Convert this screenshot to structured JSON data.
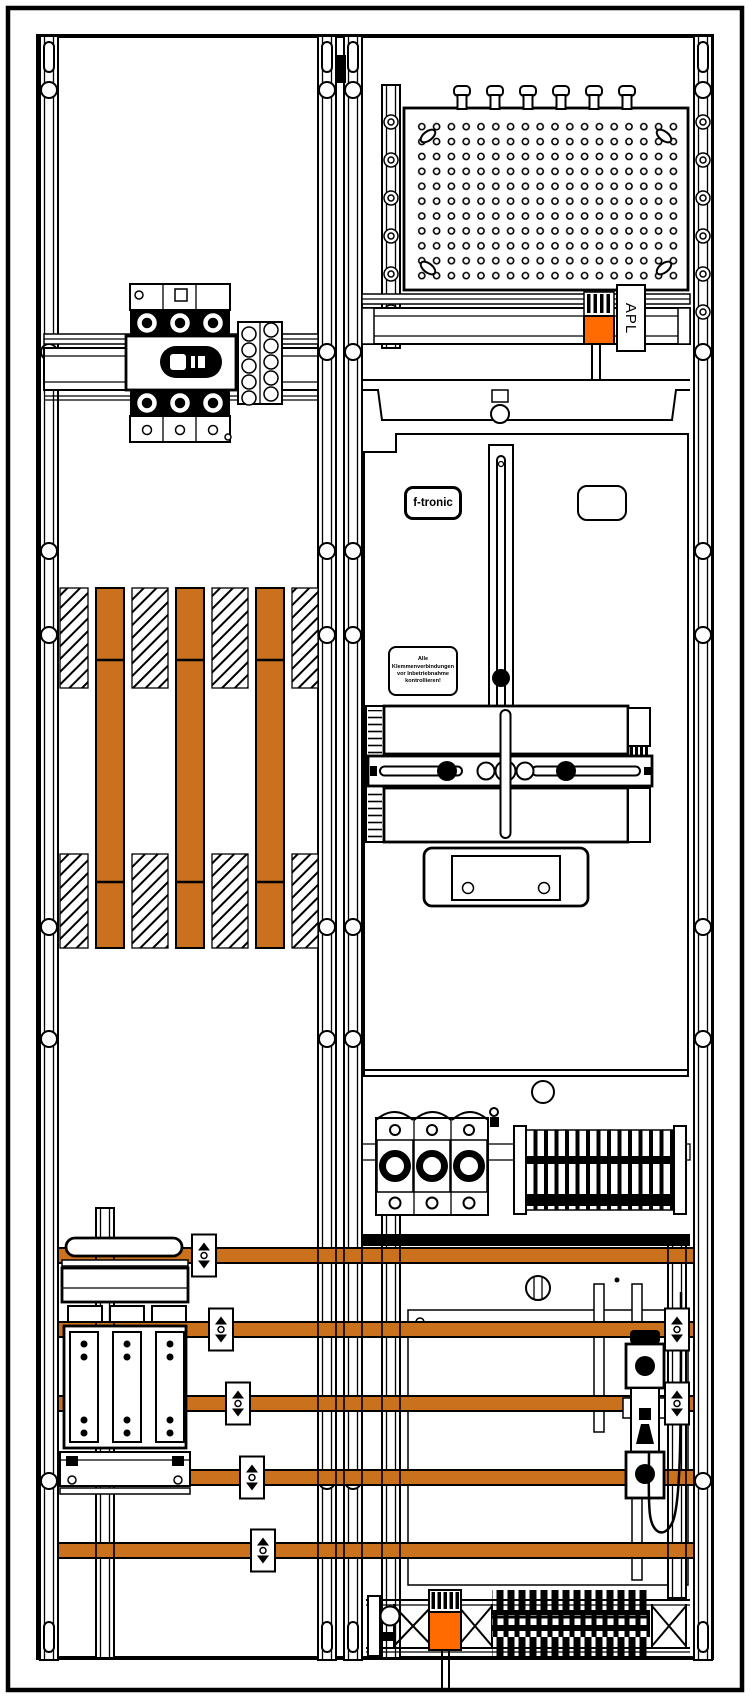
{
  "labels": {
    "apl": "APL",
    "brand_badge": "f-tronic",
    "warning_line1": "Alle Klemmenverbindungen",
    "warning_line2": "vor Inbetriebnahme",
    "warning_line3": "kontrollieren!"
  },
  "colors": {
    "busbar_copper": "#C9711D",
    "connector_orange": "#FF6B00",
    "line": "#000000",
    "background": "#FFFFFF"
  },
  "drawing": {
    "fields": 2,
    "horizontal_busbars": 5,
    "vertical_busbars": 3
  }
}
